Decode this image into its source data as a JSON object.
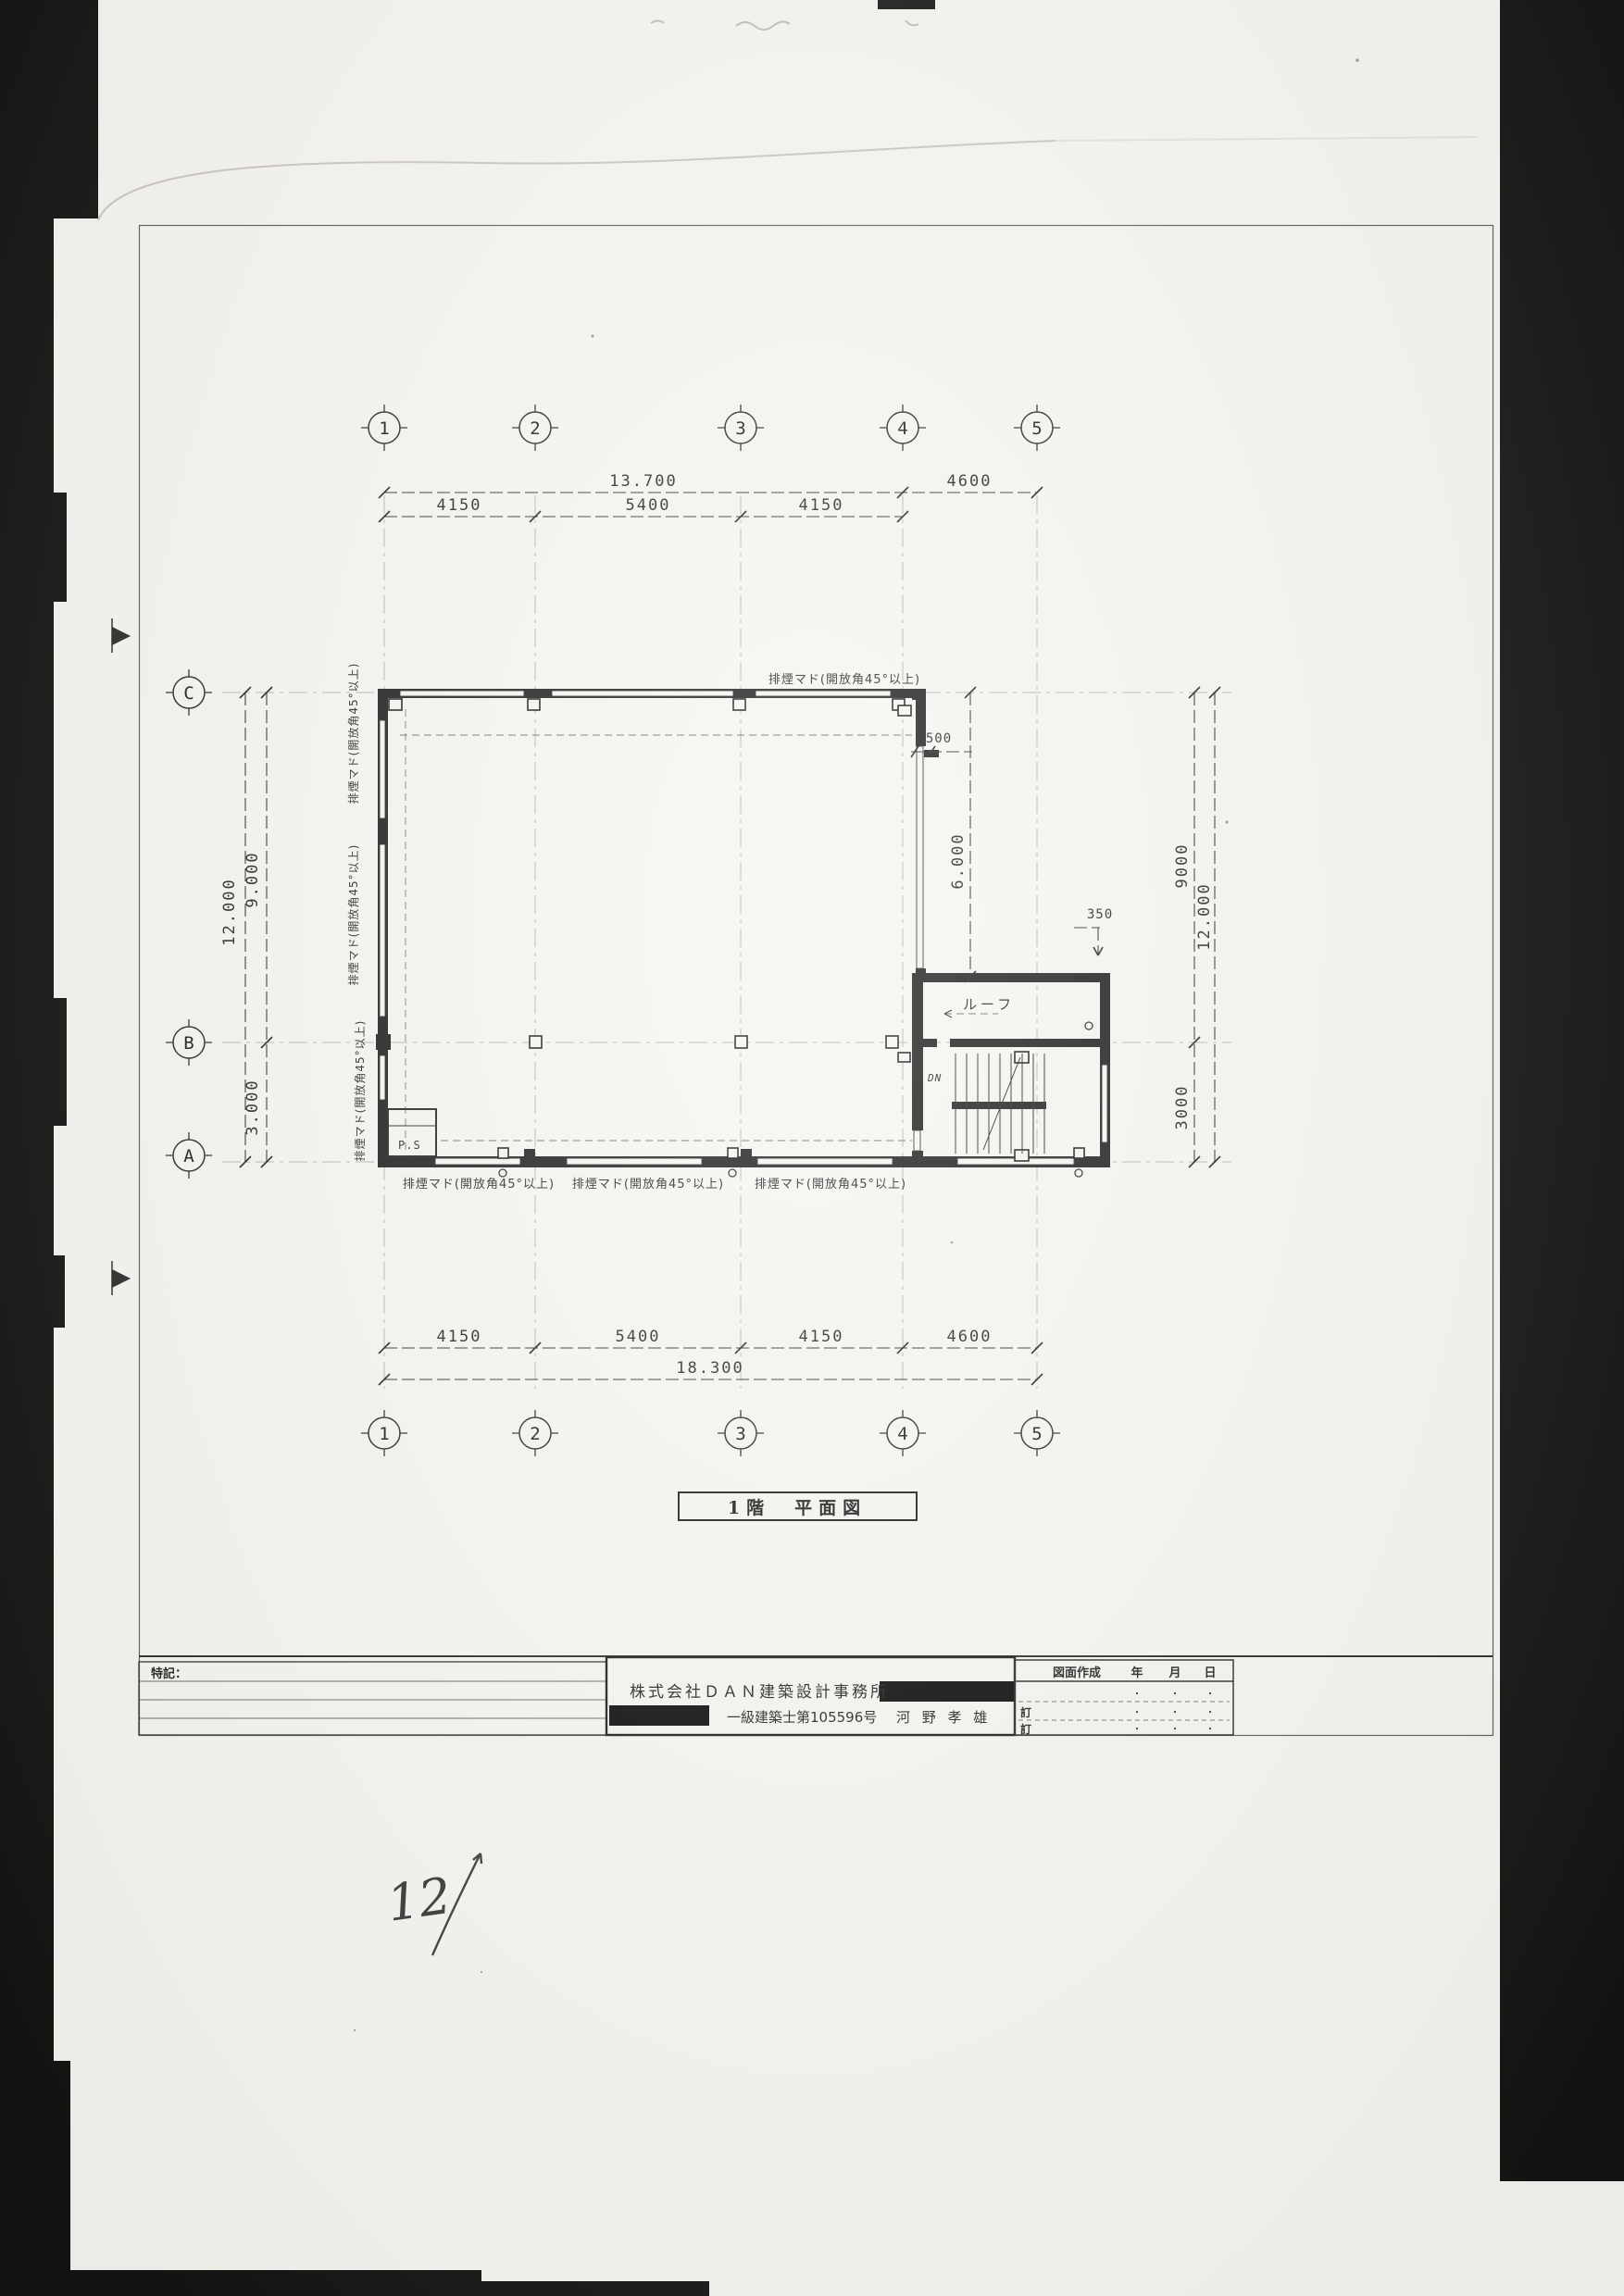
{
  "colors": {
    "paper": "#f6f5f1",
    "ink": "#1c1c1c",
    "scan_bar": "#0a0a0a"
  },
  "drawing_title": "1階　平面図",
  "grid": {
    "columns": [
      "1",
      "2",
      "3",
      "4",
      "5"
    ],
    "rows": [
      "C",
      "B",
      "A"
    ]
  },
  "dimensions": {
    "top": {
      "overall_1_to_4": "13.700",
      "span_4_to_5": "4600",
      "span_1_to_2": "4150",
      "span_2_to_3": "5400",
      "span_3_to_4": "4150"
    },
    "bottom": {
      "span_1_to_2": "4150",
      "span_2_to_3": "5400",
      "span_3_to_4": "4150",
      "span_4_to_5": "4600",
      "overall": "18.300"
    },
    "left": {
      "overall": "12.000",
      "c_to_b": "9.000",
      "b_to_a": "3.000"
    },
    "right": {
      "c_to_b": "9000",
      "b_to_a": "3000",
      "overall": "12.000",
      "stair_bay": "6.000",
      "corner_offset": "500",
      "eave_offset": "350"
    }
  },
  "annotations": {
    "smoke_vent_window": "排煙マド(開放角45°以上)",
    "roof_label": "ルーフ",
    "pipe_shaft_label": "P.S",
    "stair_direction": "DN",
    "handwritten_page_number": "12"
  },
  "title_block": {
    "notes_label": "特記：",
    "firm_name": "株式会社ＤＡＮ建築設計事務所",
    "license_number": "一級建築士第105596号",
    "architect_name": "河 野 孝 雄",
    "revision_table": {
      "created_label": "図面作成",
      "year_label": "年",
      "month_label": "月",
      "day_label": "日",
      "revision_row_label": "訂",
      "date_placeholder_dot": "・"
    }
  }
}
